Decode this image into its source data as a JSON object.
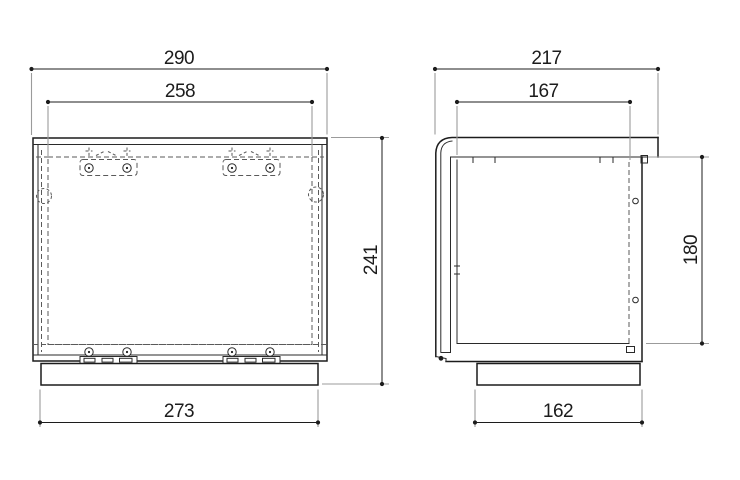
{
  "drawing": {
    "type": "orthographic-technical-drawing",
    "views": [
      {
        "id": "front",
        "description": "front elevation of enclosure"
      },
      {
        "id": "side",
        "description": "side elevation of enclosure"
      }
    ],
    "dimensions": {
      "front_overall_width": "290",
      "front_inner_width": "258",
      "front_overall_height": "241",
      "front_base_width": "273",
      "side_overall_depth": "217",
      "side_inner_depth": "167",
      "side_inner_height": "180",
      "side_base_depth": "162"
    },
    "colors": {
      "background": "#ffffff",
      "object_line": "#1c1c1c",
      "hidden_line": "#5a5a5a",
      "extension_line": "#9b9b9b",
      "dimension_text": "#1c1c1c"
    }
  }
}
